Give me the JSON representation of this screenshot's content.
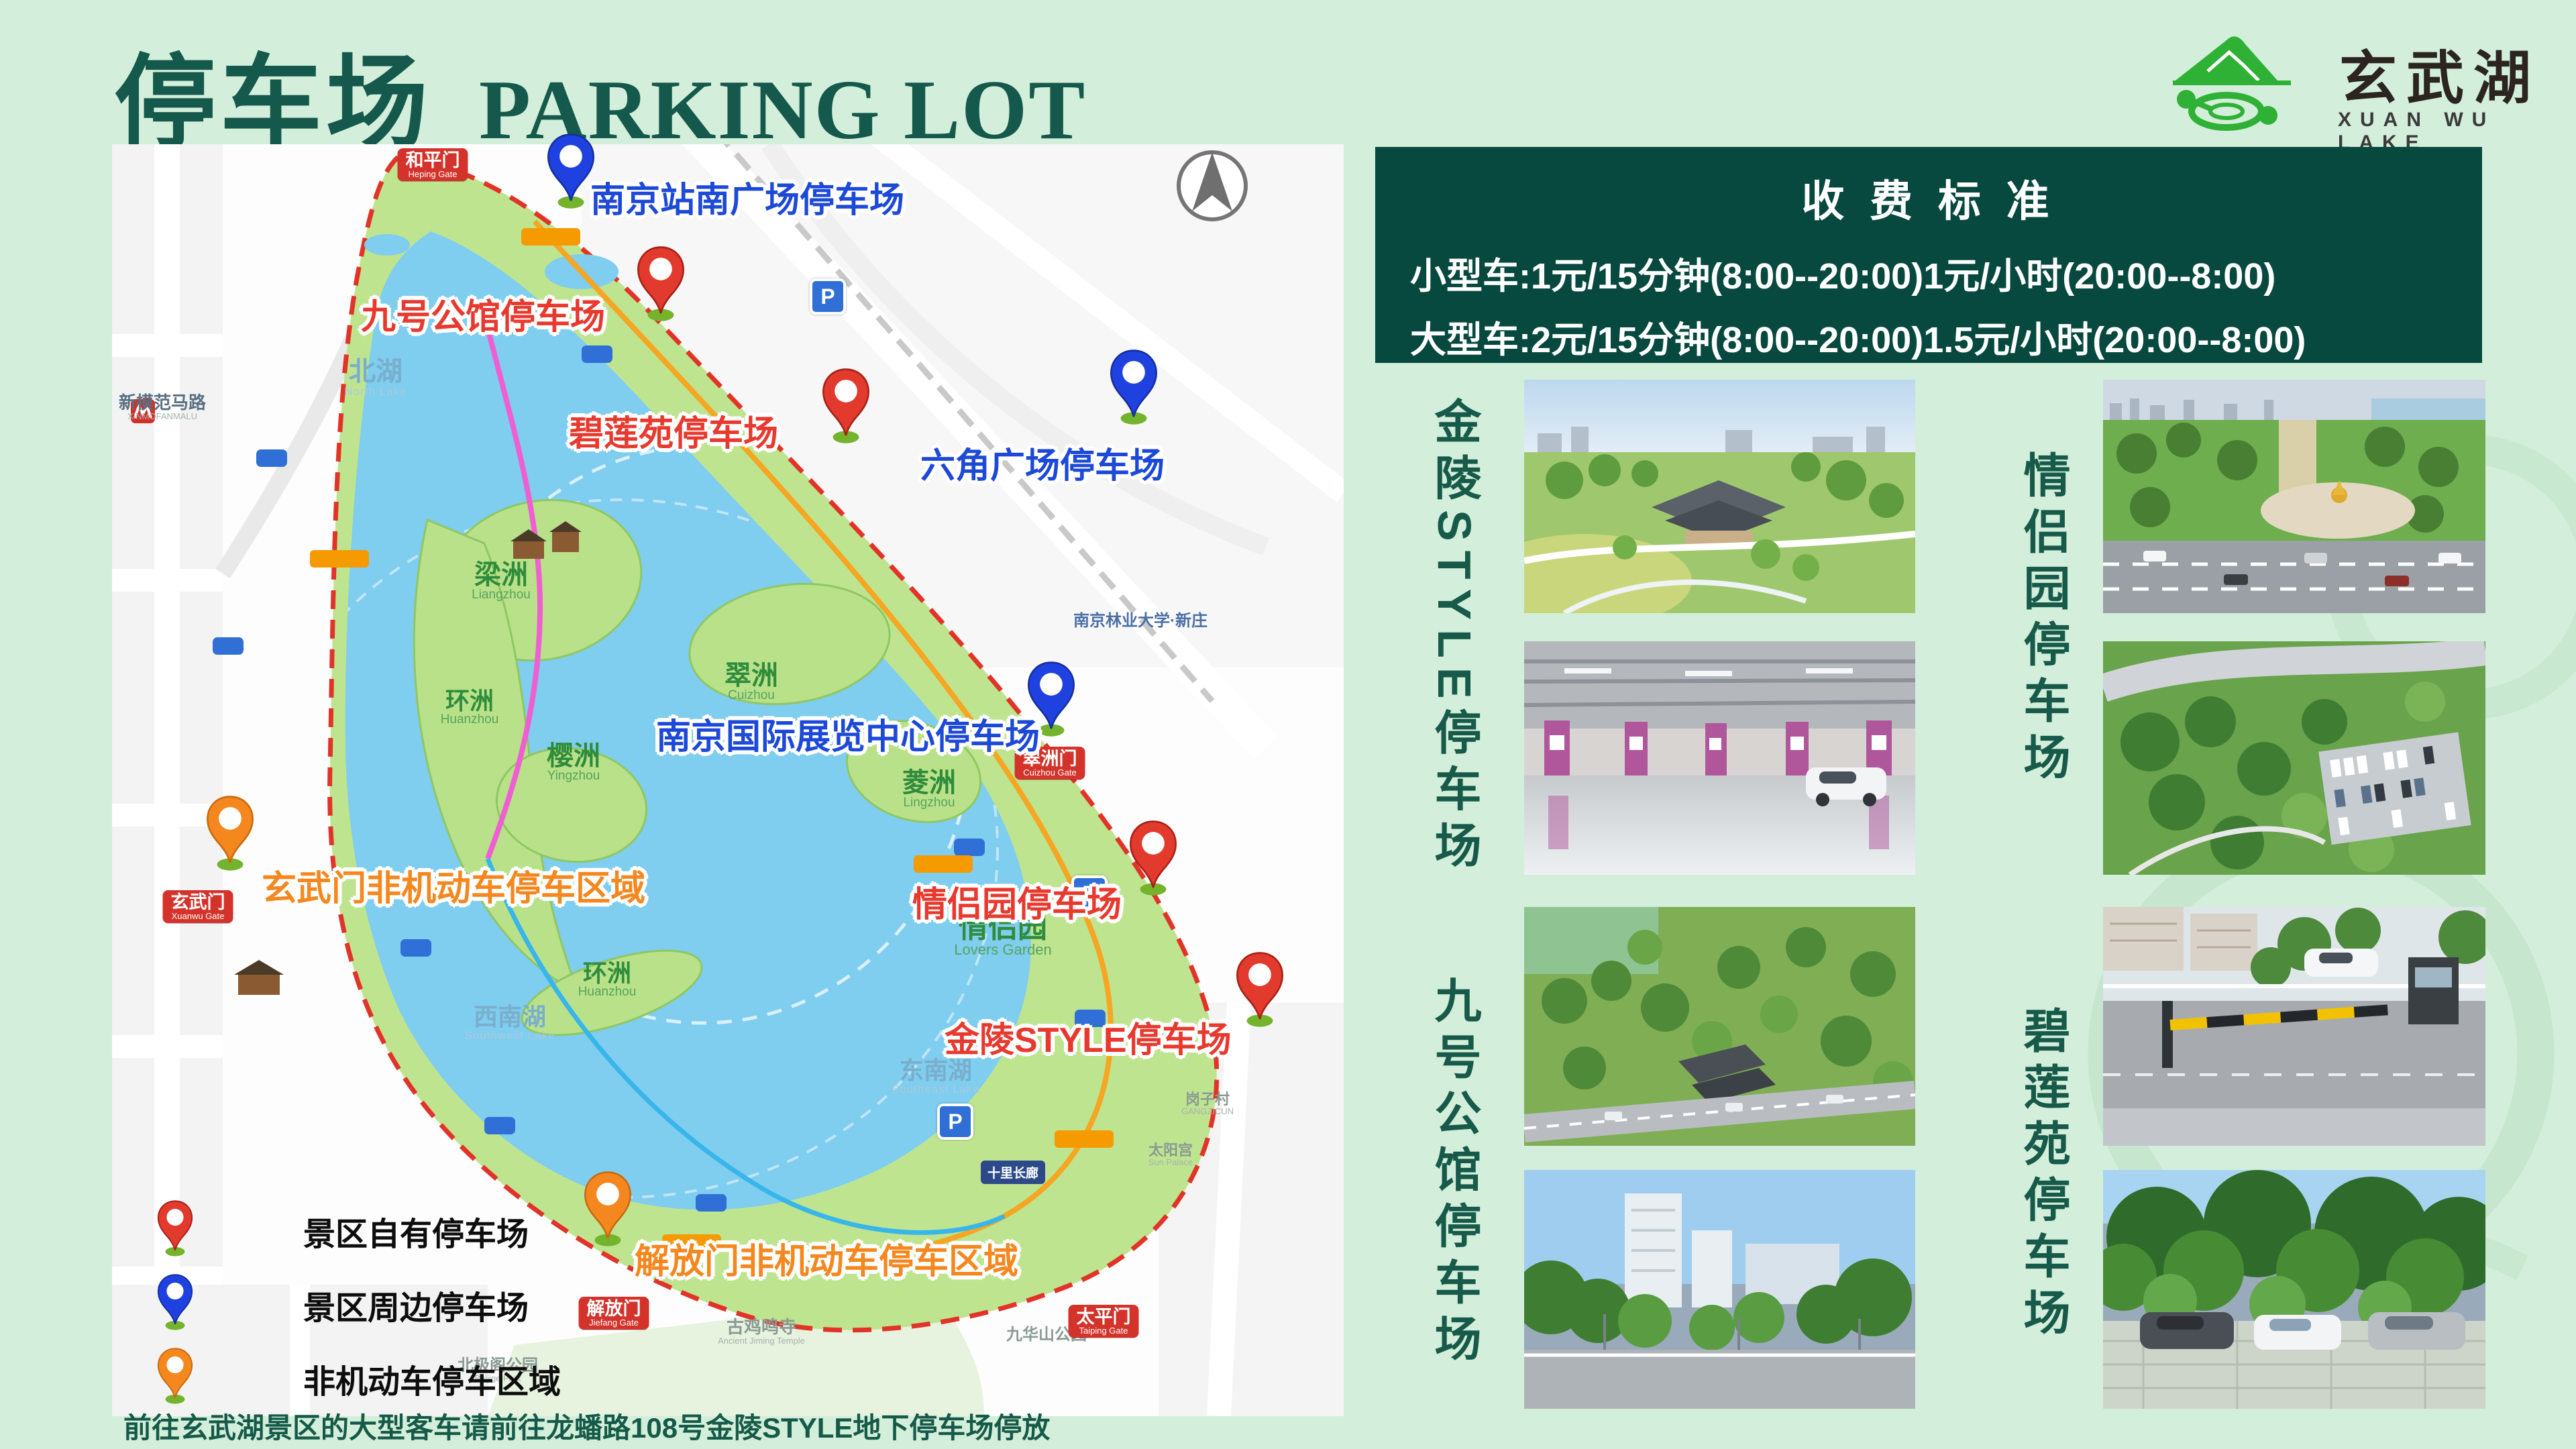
{
  "colors": {
    "page_bg": "#d3eeda",
    "title_green": "#14594b",
    "panel_green": "#07493f",
    "marker_red": "#e8392e",
    "marker_blue": "#1d49d8",
    "marker_orange": "#f5871f",
    "logo_green": "#2eb135"
  },
  "header": {
    "title_cn": "停车场",
    "title_en": "PARKING LOT"
  },
  "logo": {
    "name_cn": "玄武湖",
    "name_en": "XUAN WU LAKE"
  },
  "fee": {
    "title": "收 费 标 准",
    "line1": "小型车:1元/15分钟(8:00--20:00)1元/小时(20:00--8:00)",
    "line2": "大型车:2元/15分钟(8:00--20:00)1.5元/小时(20:00--8:00)"
  },
  "map": {
    "p_icon": "P",
    "markers": [
      {
        "label": "南京站南广场停车场",
        "type": "blue"
      },
      {
        "label": "九号公馆停车场",
        "type": "red"
      },
      {
        "label": "碧莲苑停车场",
        "type": "red"
      },
      {
        "label": "六角广场停车场",
        "type": "blue"
      },
      {
        "label": "南京国际展览中心停车场",
        "type": "blue"
      },
      {
        "label": "玄武门非机动车停车区域",
        "type": "orange"
      },
      {
        "label": "情侣园停车场",
        "type": "red"
      },
      {
        "label": "金陵STYLE停车场",
        "type": "red"
      },
      {
        "label": "解放门非机动车停车区域",
        "type": "orange"
      }
    ],
    "legend": [
      {
        "label": "景区自有停车场",
        "type": "red"
      },
      {
        "label": "景区周边停车场",
        "type": "blue"
      },
      {
        "label": "非机动车停车区域",
        "type": "orange"
      }
    ],
    "note": "前往玄武湖景区的大型客车请前往龙蟠路108号金陵STYLE地下停车场停放",
    "lakes": [
      {
        "cn": "北湖",
        "en": "North Lake"
      },
      {
        "cn": "西南湖",
        "en": "Southwest Lake"
      },
      {
        "cn": "东南湖",
        "en": "Southeast Lake"
      }
    ],
    "islands": [
      {
        "cn": "梁洲",
        "en": "Liangzhou"
      },
      {
        "cn": "翠洲",
        "en": "Cuizhou"
      },
      {
        "cn": "环洲",
        "en": "Huanzhou"
      },
      {
        "cn": "樱洲",
        "en": "Yingzhou"
      },
      {
        "cn": "菱洲",
        "en": "Lingzhou"
      },
      {
        "cn": "环洲",
        "en": "Huanzhou"
      },
      {
        "cn": "情侣园",
        "en": "Lovers Garden"
      }
    ],
    "gates": [
      {
        "cn": "和平门",
        "en": "Heping Gate"
      },
      {
        "cn": "玄武门",
        "en": "Xuanwu Gate"
      },
      {
        "cn": "翠洲门",
        "en": "Cuizhou Gate"
      },
      {
        "cn": "解放门",
        "en": "Jiefang Gate"
      },
      {
        "cn": "太平门",
        "en": "Taiping Gate"
      }
    ],
    "pois": [
      {
        "cn": "新模范马路",
        "en": "XINMOFANMALU"
      },
      {
        "cn": "南京林业大学·新庄",
        "en": ""
      },
      {
        "cn": "古鸡鸣寺",
        "en": "Ancient Jiming Temple"
      },
      {
        "cn": "北极阁公园",
        "en": "Beijige Park"
      },
      {
        "cn": "九华山公园",
        "en": ""
      },
      {
        "cn": "太阳宫",
        "en": "Sun Palace"
      },
      {
        "cn": "岗子村",
        "en": "GANGZICUN"
      },
      {
        "cn": "十里长廊",
        "en": ""
      }
    ]
  },
  "gallery": {
    "sections": [
      {
        "label": "金陵STYLE停车场"
      },
      {
        "label": "九号公馆停车场"
      },
      {
        "label": "情侣园停车场"
      },
      {
        "label": "碧莲苑停车场"
      }
    ]
  }
}
